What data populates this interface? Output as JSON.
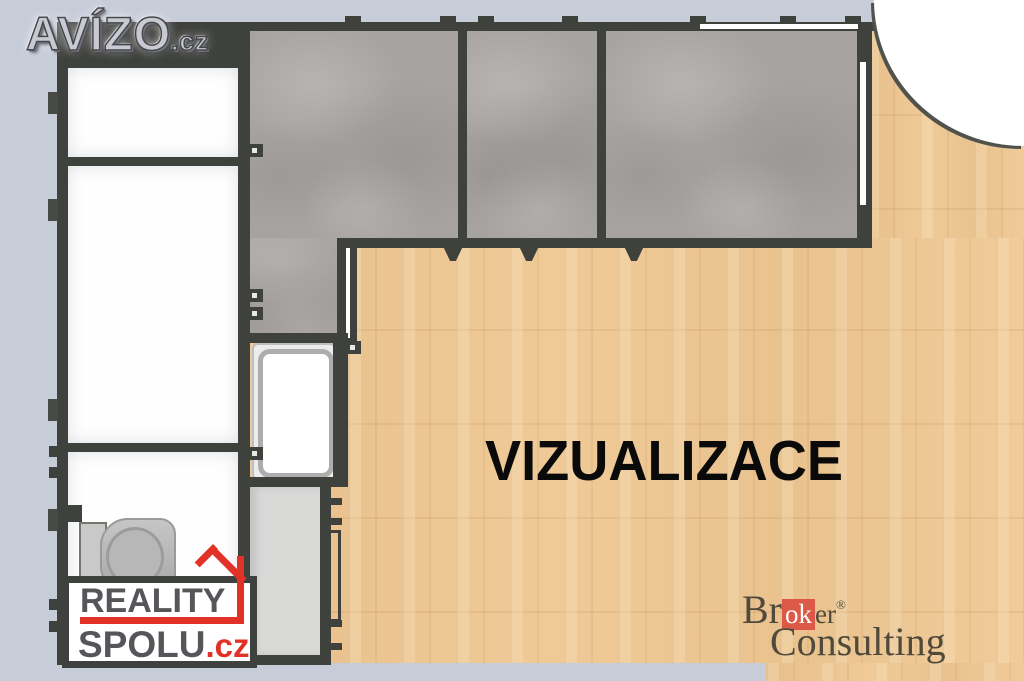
{
  "branding": {
    "avizo": {
      "text": "AVÍZO",
      "suffix": ".cz"
    },
    "reality_spolu": {
      "line1": "REALITY",
      "line2": "SPOLU",
      "suffix": ".cz",
      "accent_color": "#e23127",
      "text_color": "#55565a"
    },
    "broker_consulting": {
      "part1": "Br",
      "boxed": "ok",
      "part2": "er",
      "registered": "®",
      "line2": "Consulting",
      "box_color": "#db5946",
      "text_color": "#4f4a3c"
    }
  },
  "watermark": {
    "text": "VIZUALIZACE",
    "color": "#0a0a0a"
  },
  "palette": {
    "background": "#c7ccd9",
    "wall": "#3f413d",
    "concrete": "#a7a3a0",
    "wood": "#ebc593",
    "room_white": "#ffffff",
    "corridor": "#d9d9d8"
  }
}
